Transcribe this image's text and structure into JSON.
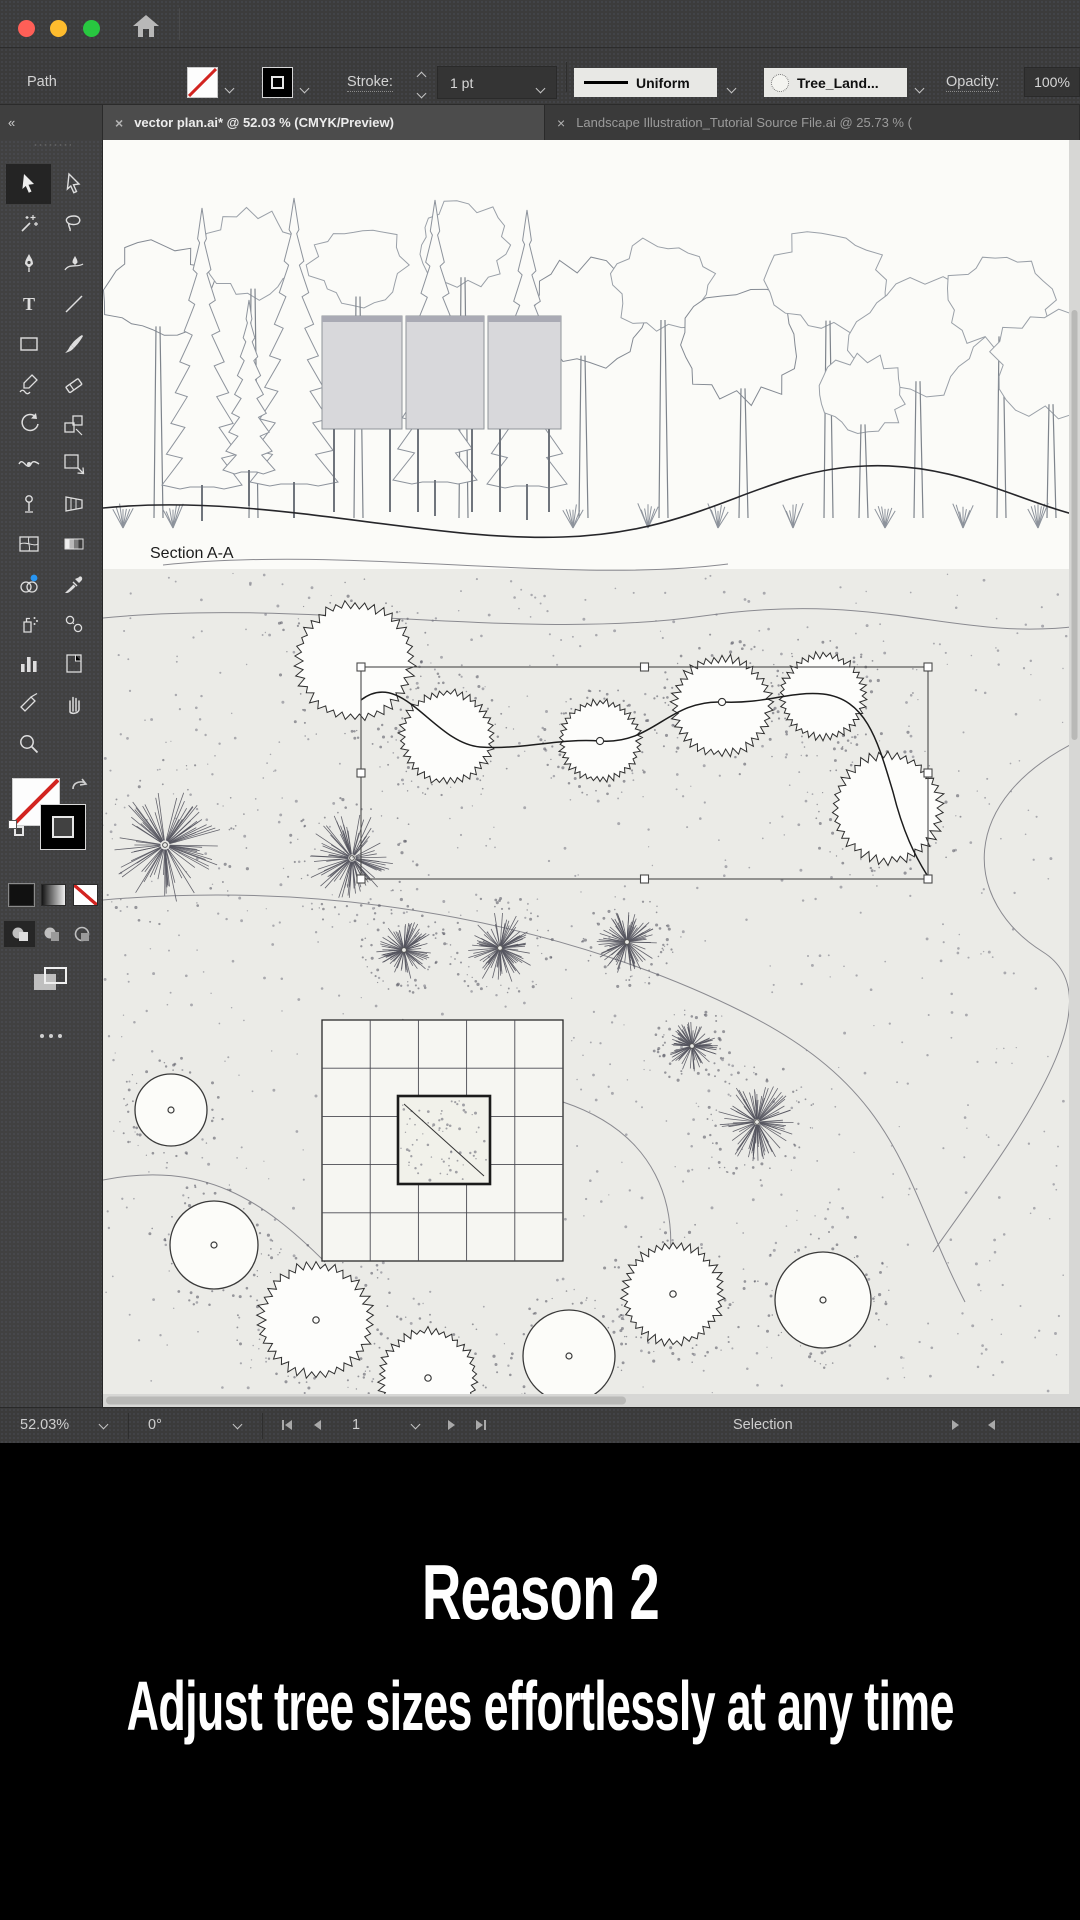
{
  "icons": {
    "close": "×",
    "collapse": "«"
  },
  "control_bar": {
    "context_label": "Path",
    "stroke_label": "Stroke:",
    "stroke_weight": "1 pt",
    "width_profile": "Uniform",
    "brush_name": "Tree_Land...",
    "opacity_label": "Opacity:",
    "opacity_value": "100%"
  },
  "tabs": [
    {
      "label": "vector plan.ai* @ 52.03 % (CMYK/Preview)",
      "active": true
    },
    {
      "label": "Landscape Illustration_Tutorial Source File.ai @ 25.73 % (",
      "active": false
    }
  ],
  "toolbar": {
    "tools": [
      {
        "name": "selection",
        "selected": true
      },
      {
        "name": "direct-selection"
      },
      {
        "name": "magic-wand"
      },
      {
        "name": "lasso"
      },
      {
        "name": "pen"
      },
      {
        "name": "curvature"
      },
      {
        "name": "type"
      },
      {
        "name": "line-segment"
      },
      {
        "name": "rectangle"
      },
      {
        "name": "paintbrush"
      },
      {
        "name": "shaper"
      },
      {
        "name": "eraser"
      },
      {
        "name": "rotate"
      },
      {
        "name": "scale"
      },
      {
        "name": "width"
      },
      {
        "name": "free-transform"
      },
      {
        "name": "puppet-warp"
      },
      {
        "name": "perspective-grid"
      },
      {
        "name": "mesh"
      },
      {
        "name": "gradient"
      },
      {
        "name": "shape-builder"
      },
      {
        "name": "eyedropper"
      },
      {
        "name": "symbol-sprayer"
      },
      {
        "name": "blend"
      },
      {
        "name": "column-graph"
      },
      {
        "name": "artboard"
      },
      {
        "name": "slice"
      },
      {
        "name": "hand"
      },
      {
        "name": "zoom"
      }
    ]
  },
  "canvas": {
    "section_label": "Section A-A"
  },
  "status_bar": {
    "zoom": "52.03%",
    "rotation": "0°",
    "artboard_nav_value": "1",
    "tool_name": "Selection"
  },
  "caption": {
    "line1": "Reason 2",
    "line2": "Adjust tree sizes effortlessly at any time"
  },
  "colors": {
    "accent_blue": "#2795f2",
    "none_red": "#d22420",
    "traffic": [
      "#ff5f57",
      "#febc2e",
      "#28c840"
    ]
  },
  "illustration": {
    "elevation_split": 429,
    "selection_box": {
      "x": 258,
      "y": 527,
      "w": 567,
      "h": 212
    },
    "selected_path": "M258,560 C300,528 330,603 377,607 C420,610 455,598 497,601 C550,605 565,560 619,562 C663,564 686,551 720,554 C764,559 775,602 790,652 C800,692 812,716 824,735",
    "path_anchors": [
      [
        497,
        601
      ],
      [
        619,
        562
      ]
    ],
    "fuzzy_trees": [
      [
        252,
        521,
        58,
        0
      ],
      [
        344,
        597,
        46,
        0
      ],
      [
        497,
        601,
        40,
        0
      ],
      [
        619,
        566,
        49,
        0
      ],
      [
        720,
        556,
        42,
        0
      ],
      [
        785,
        668,
        54,
        0
      ],
      [
        213,
        1180,
        56,
        1
      ],
      [
        325,
        1238,
        48,
        1
      ],
      [
        570,
        1154,
        50,
        1
      ]
    ],
    "plain_trees": [
      [
        68,
        970,
        36
      ],
      [
        111,
        1105,
        44
      ],
      [
        466,
        1216,
        46
      ],
      [
        720,
        1160,
        48
      ]
    ],
    "starburst_trees": [
      [
        62,
        705,
        58
      ],
      [
        249,
        718,
        46
      ],
      [
        301,
        810,
        30
      ],
      [
        397,
        808,
        36
      ],
      [
        524,
        802,
        32
      ],
      [
        589,
        906,
        26
      ],
      [
        654,
        982,
        40
      ]
    ],
    "pergola": {
      "x": 219,
      "y": 880,
      "size": 241,
      "cells": 5,
      "inner": {
        "x": 295,
        "y": 956,
        "w": 92,
        "h": 88
      }
    },
    "contours": [
      "M0,478 C200,458 420,502 600,476 S850,502 977,486",
      "M60,425 C250,405 460,445 625,424",
      "M0,760 C250,738 480,792 640,872 S800,1042 862,1162",
      "M977,600 C852,660 860,762 940,812 S900,1012 830,1112",
      "M0,1040 C100,1020 160,1060 222,1122",
      "M460,962 C550,992 582,1062 562,1152"
    ],
    "ground": "M0,368 C160,352 320,402 460,397 C600,393 655,330 762,326 C852,322 912,360 977,376",
    "boards": [
      [
        219,
        176,
        80,
        113
      ],
      [
        303,
        176,
        78,
        113
      ],
      [
        385,
        176,
        73,
        113
      ]
    ],
    "conifers": [
      [
        99,
        345,
        68,
        40
      ],
      [
        191,
        342,
        58,
        44
      ],
      [
        332,
        340,
        60,
        42
      ],
      [
        424,
        344,
        70,
        40
      ],
      [
        146,
        330,
        160,
        26
      ]
    ],
    "canopies": [
      [
        55,
        150,
        52
      ],
      [
        150,
        115,
        48
      ],
      [
        255,
        125,
        45
      ],
      [
        360,
        105,
        46
      ],
      [
        480,
        175,
        58
      ],
      [
        560,
        145,
        50
      ],
      [
        640,
        205,
        62
      ],
      [
        725,
        140,
        58
      ],
      [
        815,
        195,
        66
      ],
      [
        898,
        160,
        52
      ],
      [
        948,
        225,
        56
      ],
      [
        760,
        255,
        42
      ]
    ],
    "shrub_xs": [
      20,
      70,
      470,
      545,
      615,
      690,
      782,
      860,
      935
    ]
  }
}
